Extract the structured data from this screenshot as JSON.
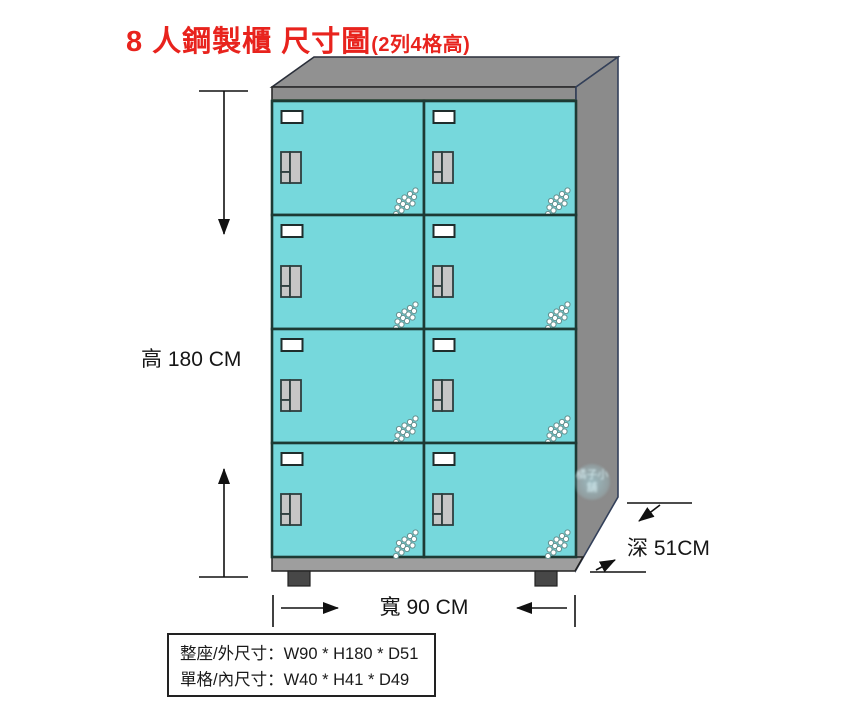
{
  "title": {
    "main": "8 人鋼製櫃 尺寸圖",
    "sub": "(2列4格高)",
    "color": "#e8231d"
  },
  "cabinet": {
    "rows": 4,
    "cols": 2,
    "door_color": "#76d8dc",
    "door_stroke": "#1d3a34",
    "top_color": "#919191",
    "side_color": "#8b8b8b",
    "base_color": "#9e9e9e",
    "foot_color": "#474747",
    "handle_color": "#c6c6c6",
    "tag_color": "#ffffff",
    "frame_accent_green": "#3a7d44"
  },
  "dimensions": {
    "height_label": "高 180 CM",
    "width_label": "寬 90 CM",
    "depth_label": "深 51CM"
  },
  "spec_box": {
    "line1": "整座/外尺寸：W90 * H180 * D51",
    "line2": "單格/內尺寸：W40 * H41 * D49"
  },
  "watermark": {
    "text": "橘子小舖"
  }
}
